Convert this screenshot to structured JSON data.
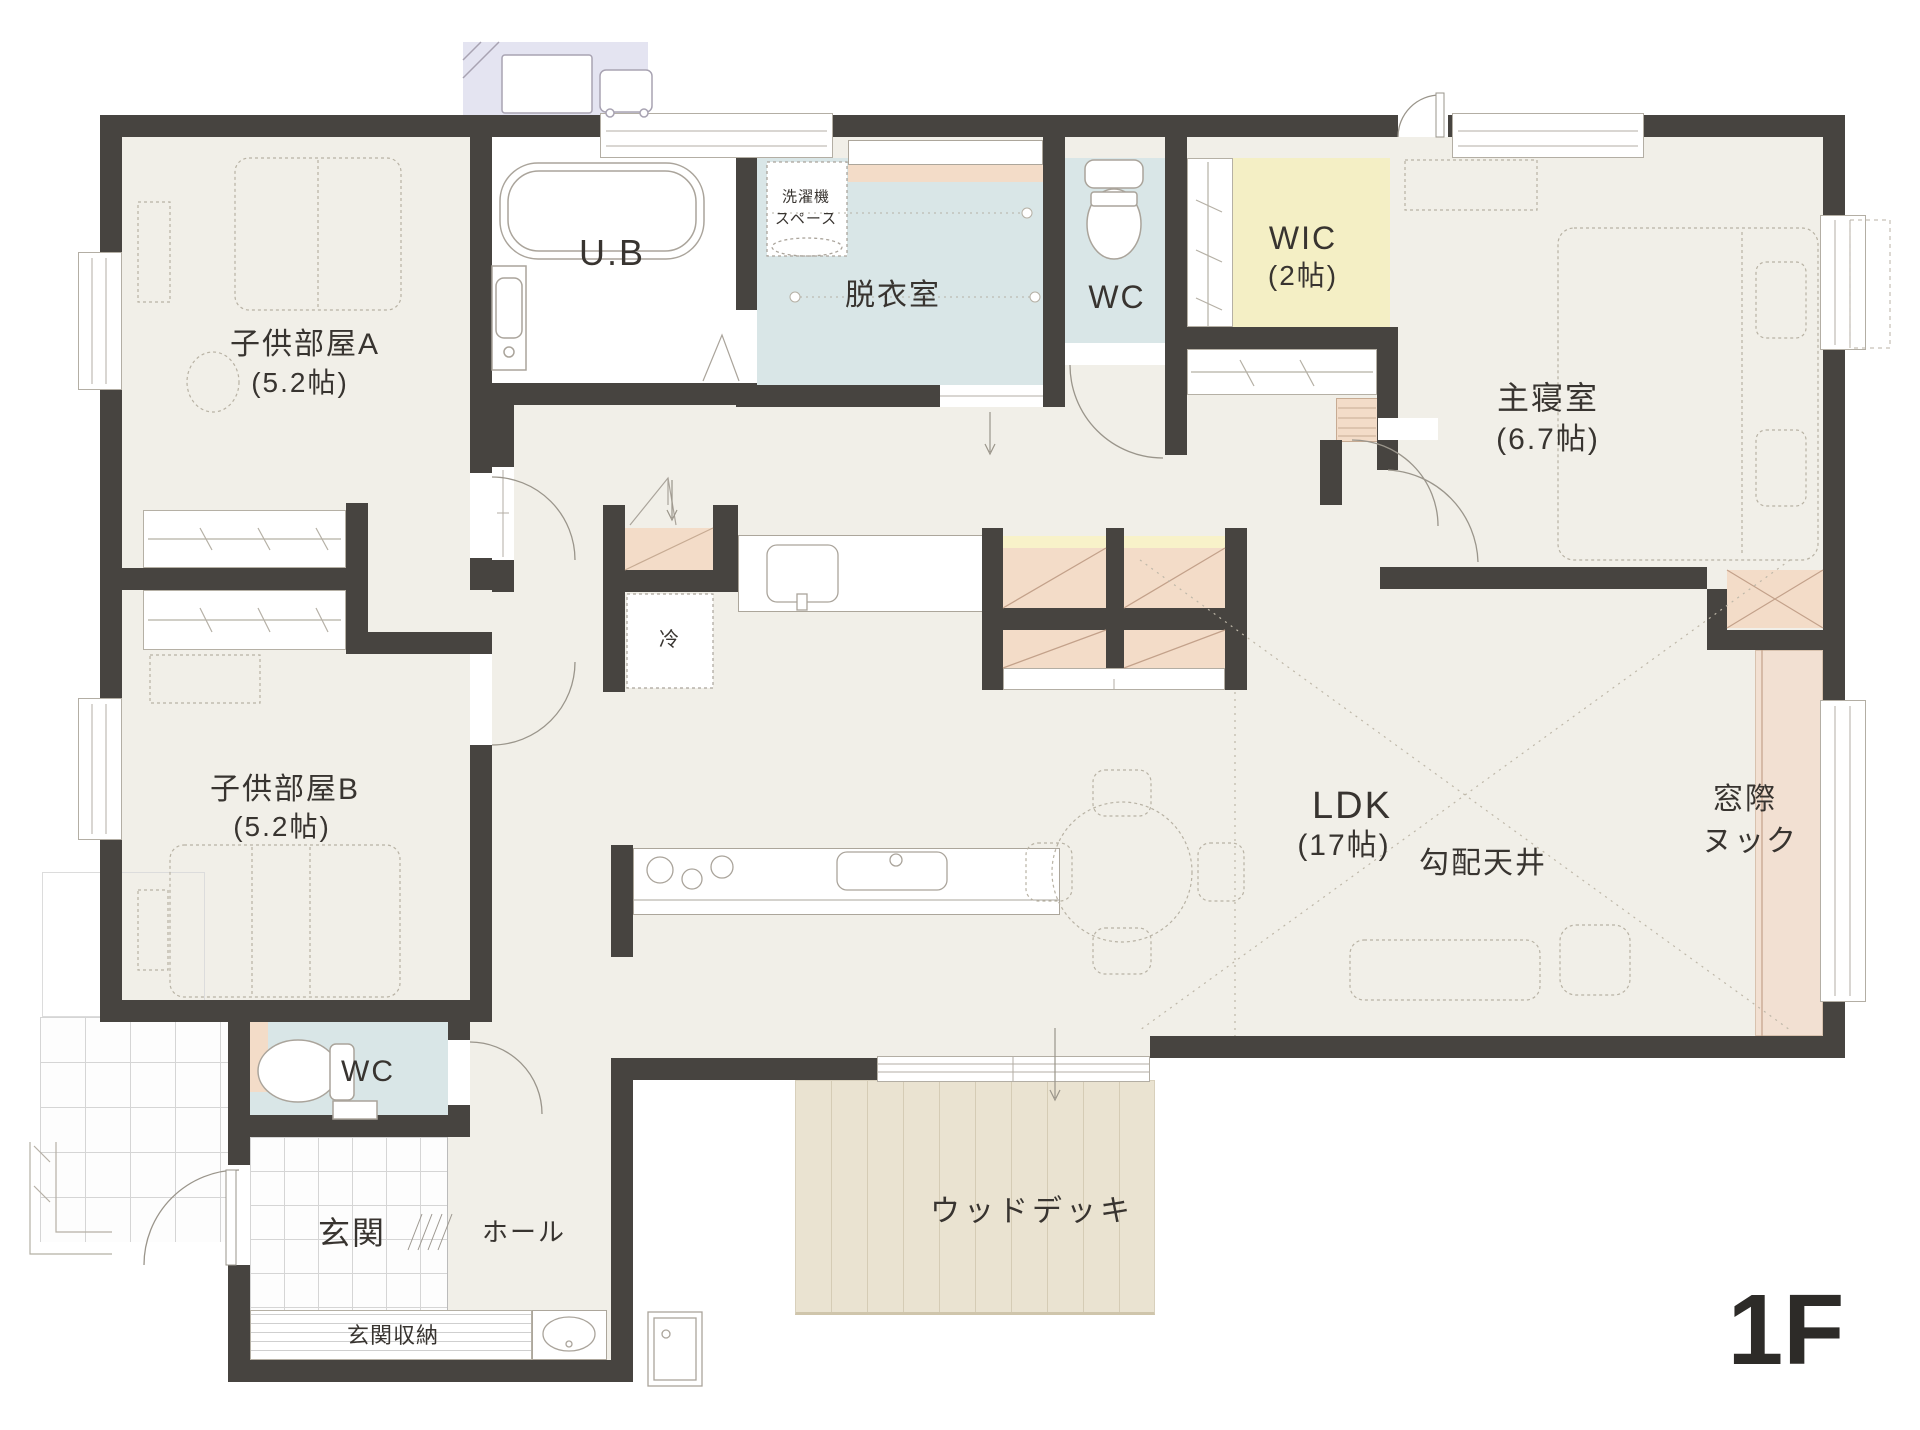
{
  "title": "1F floor plan",
  "labels": {
    "kids_a_name": "子供部屋A",
    "kids_a_size": "(5.2帖)",
    "kids_b_name": "子供部屋B",
    "kids_b_size": "(5.2帖)",
    "ub": "U.B",
    "laundry": "脱衣室",
    "washer_1": "洗濯機",
    "washer_2": "スペース",
    "wc_top": "WC",
    "wc_bottom": "WC",
    "wic_name": "WIC",
    "wic_size": "(2帖)",
    "master_name": "主寝室",
    "master_size": "(6.7帖)",
    "fridge": "冷",
    "ldk_name": "LDK",
    "ldk_size": "(17帖)",
    "slope": "勾配天井",
    "nook_1": "窓際",
    "nook_2": "ヌック",
    "genkan": "玄関",
    "hall": "ホール",
    "shoe_storage": "玄関収納",
    "wood_deck": "ウッドデッキ",
    "floor": "1F"
  },
  "colors": {
    "wall": "#474440",
    "floor_cream": "#f1efe8",
    "wet_blue": "#d9e6e7",
    "wic_yellow": "#f4efc5",
    "shelf_yellow": "#f8f2c9",
    "closet_peach": "#f3dcc8",
    "deck_tan": "#eae3d1",
    "outdoor_pad": "#e4e4f1",
    "text": "#383430"
  }
}
